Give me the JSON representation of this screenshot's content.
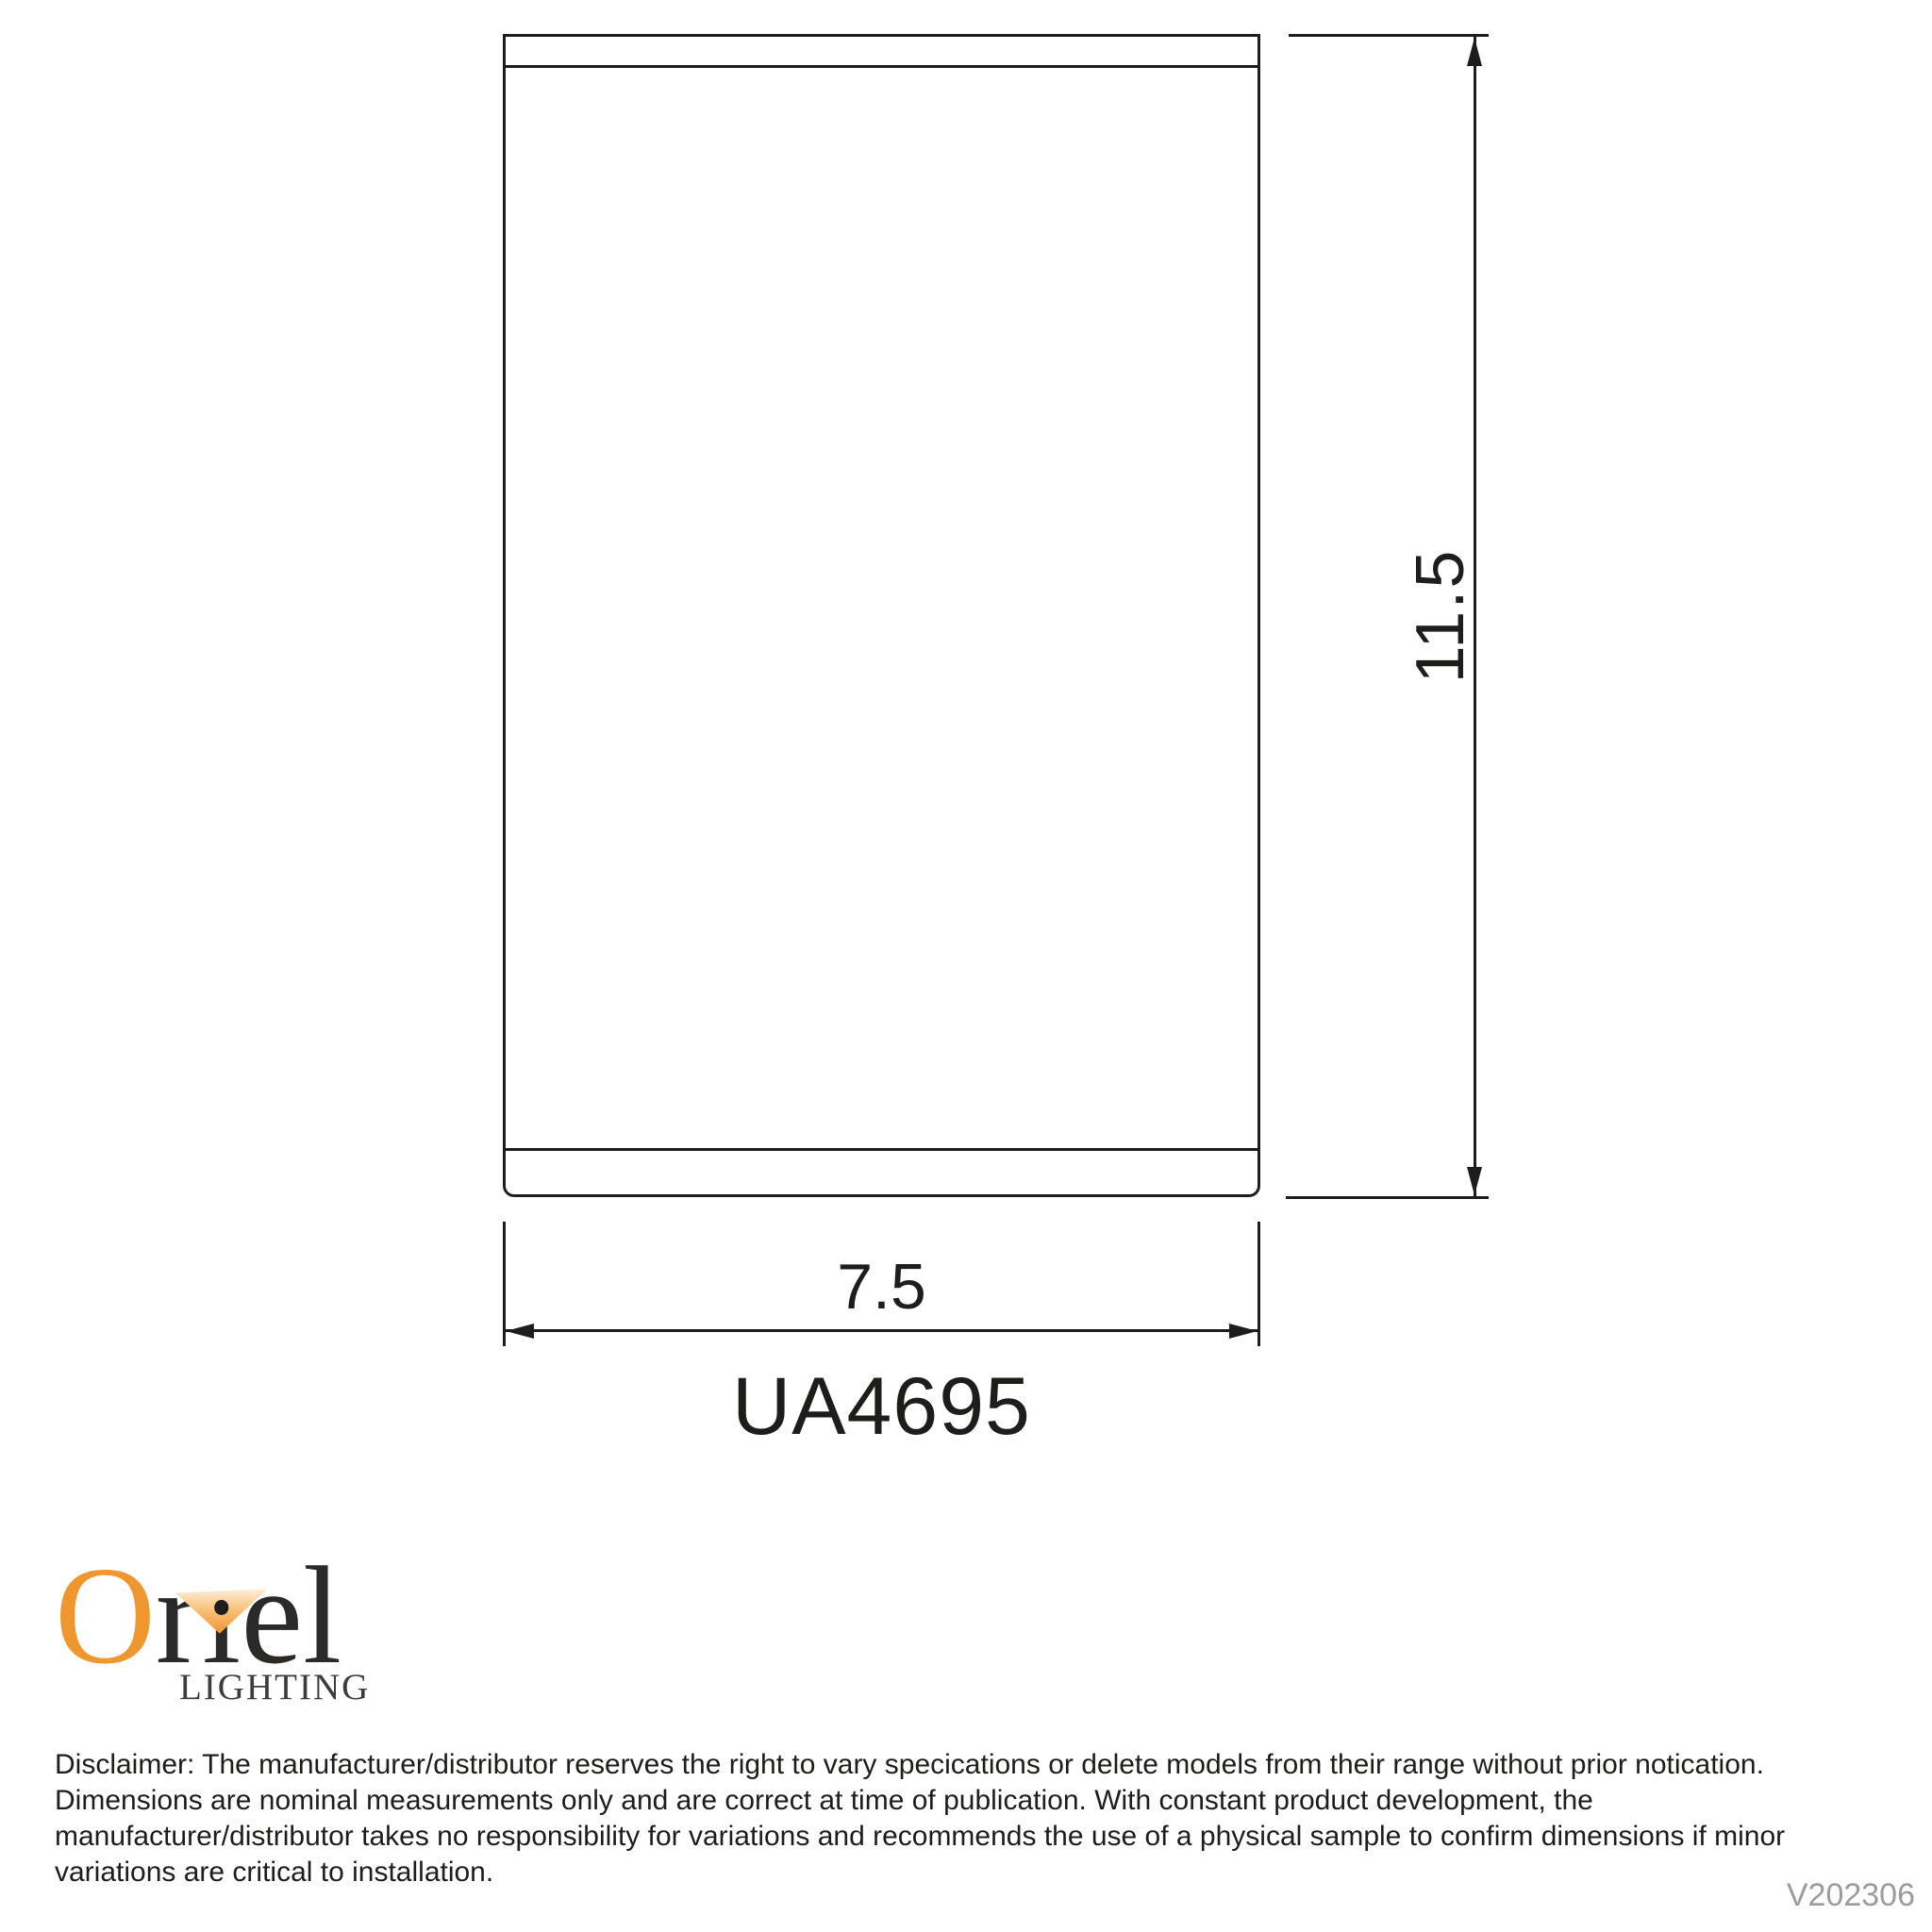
{
  "drawing": {
    "product_code": "UA4695",
    "width_dim_label": "7.5",
    "height_dim_label": "11.5",
    "line_color": "#1d1d1b"
  },
  "logo": {
    "brand": "Oriel",
    "brand_part_o": "O",
    "brand_part_r": "r",
    "brand_part_i": "ı",
    "brand_part_el": "el",
    "subtext": "LIGHTING",
    "orange": "#f0962e"
  },
  "disclaimer": {
    "lines": [
      "Disclaimer: The manufacturer/distributor reserves the right to vary specications or delete models from their range without prior notication.",
      "Dimensions are nominal measurements only and are correct at time of publication. With constant product development, the",
      "manufacturer/distributor takes no responsibility for variations and recommends the use of a physical sample to confirm dimensions if minor",
      "variations are critical to installation."
    ]
  },
  "footer": {
    "version": "V202306"
  }
}
